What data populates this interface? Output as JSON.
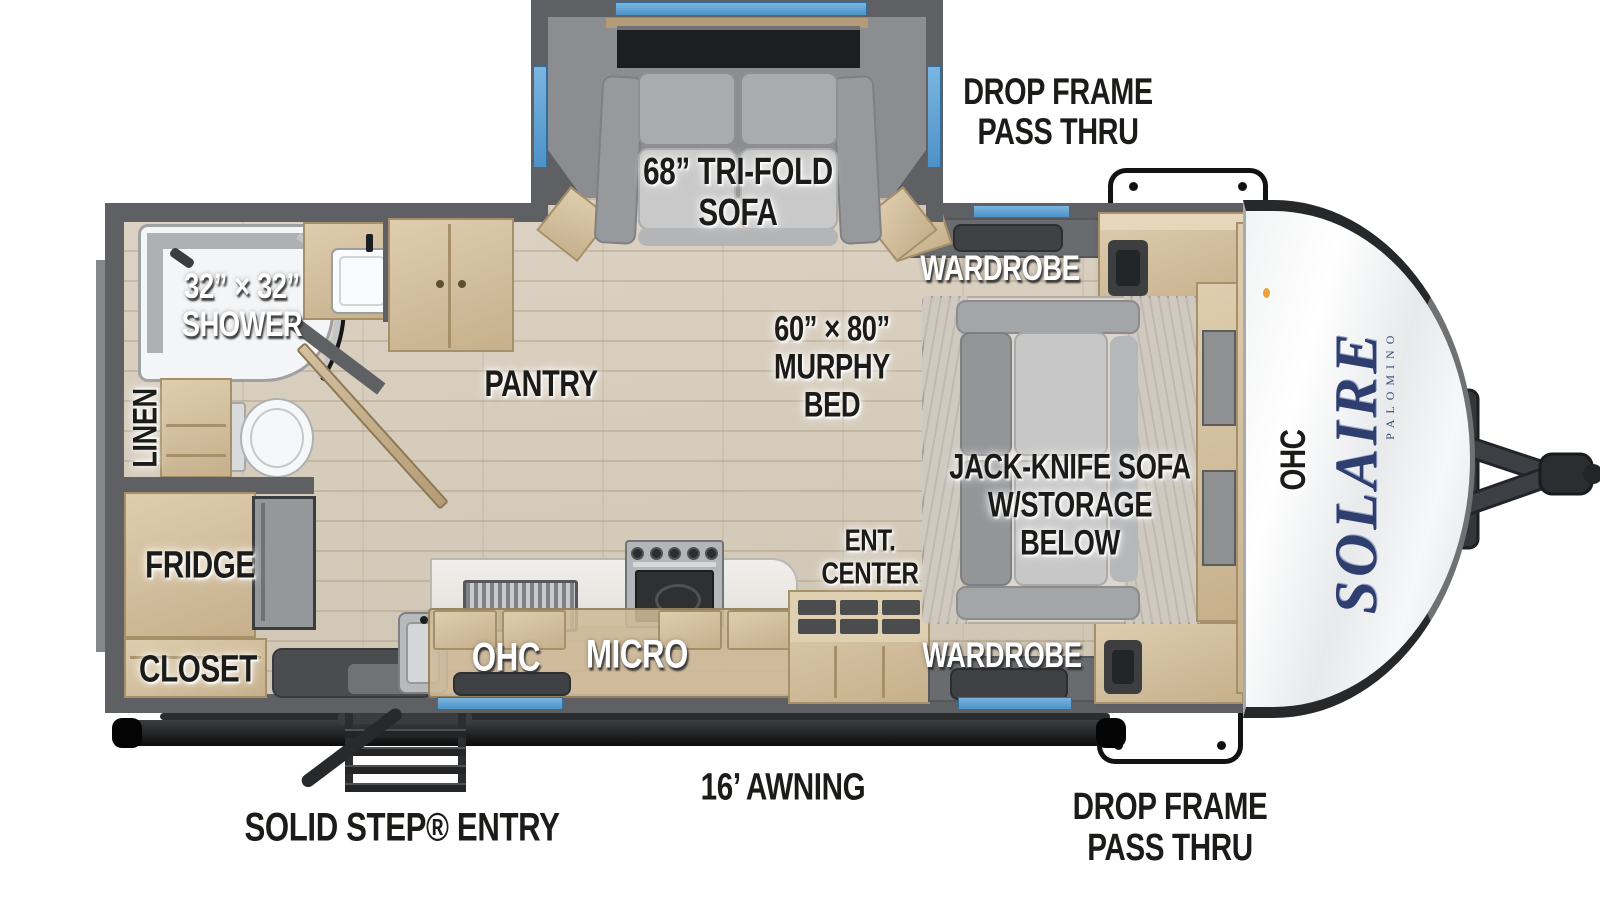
{
  "exterior": {
    "drop_frame_top": "DROP FRAME\nPASS THRU",
    "drop_frame_bottom": "DROP FRAME\nPASS THRU",
    "awning": "16’ AWNING",
    "entry": "SOLID STEP® ENTRY",
    "brand": "SOLAIRE",
    "brand_sub": "PALOMINO",
    "front_ohc": "OHC"
  },
  "living": {
    "trifold_sofa": "68” TRI-FOLD\nSOFA",
    "pantry": "PANTRY",
    "ent_center": "ENT.\nCENTER"
  },
  "bedroom": {
    "wardrobe_top": "WARDROBE",
    "wardrobe_bottom": "WARDROBE",
    "murphy_bed": "60” × 80”\nMURPHY\nBED",
    "jack_knife_sofa": "JACK-KNIFE SOFA\nW/STORAGE\nBELOW"
  },
  "bath": {
    "shower": "32” × 32”\nSHOWER",
    "linen": "LINEN"
  },
  "kitchen": {
    "ohc": "OHC",
    "micro": "MICRO",
    "fridge": "FRIDGE",
    "closet": "CLOSET"
  },
  "colors": {
    "window_blue": "#5AA0D4",
    "brand_navy": "#2D3E6F",
    "wall_gray": "#5E6064",
    "floor_tan": "#D8CFC0",
    "cabinet_tan": "#D5C2A3",
    "label_black": "#1B1B19",
    "label_white": "#FFFFFF"
  }
}
